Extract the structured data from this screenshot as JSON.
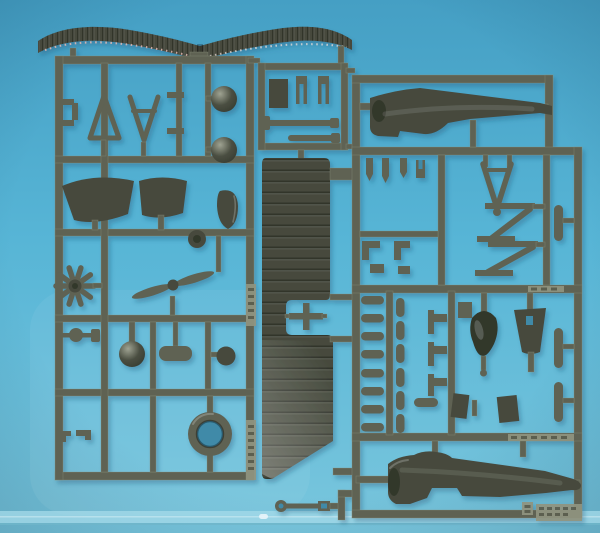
{
  "scene": {
    "type": "photograph",
    "subject": "Two dark olive-grey injection-molded model aircraft sprues on a light blue backdrop",
    "backdrop": "light blue paper with a fold line near the bottom edge",
    "plastic_description": "matte dark olive-grey styrene, light glinting on wing corrugations",
    "sprue_count": 3
  },
  "colors": {
    "backdrop_top": "#459fc4",
    "backdrop_mid": "#57b5d6",
    "backdrop_bottom": "#79c6dd",
    "table_strip": "#a6dbe9",
    "table_line": "#6fb5c9",
    "plastic": "#5e6253",
    "plastic_light": "#90947f",
    "plastic_dark": "#464a3d",
    "plastic_darker": "#33372c",
    "plastic_shine": "#b9bdae",
    "rib_glint": "#d2a8a2",
    "hole_shadow": "#3f8aa8",
    "shadow": "#16506e"
  },
  "sprues": {
    "left": {
      "name": "left parts frame",
      "parts": [
        "corrugated upper wing",
        "fuselage bracket",
        "windscreen frame",
        "cabane vee strut",
        "domed bowls",
        "seat fairings",
        "headrest fin",
        "wheel hub",
        "radial engine",
        "two-blade propeller",
        "axle shaft",
        "spinner dome",
        "seat pad",
        "wheel disc",
        "spring clips",
        "cowling ring",
        "embossed part-number plates"
      ]
    },
    "center": {
      "name": "lower wing and fittings",
      "parts": [
        "one-piece corrugated lower wing",
        "center-section cross brace",
        "control linkage rod",
        "small rod fittings",
        "fork fittings",
        "equipment box"
      ]
    },
    "right": {
      "name": "right parts frame",
      "parts": [
        "upper fuselage half",
        "lower fuselage half",
        "tail-skid vee strut",
        "diagonal interplane struts",
        "engine cylinders",
        "nose cowl bell",
        "tail fin",
        "tee fittings",
        "hook fittings",
        "axle capsules",
        "embossed maker plates"
      ]
    }
  },
  "embossed_text": {
    "legible": false,
    "description": "raised molded lettering on runner tags, too small to read"
  }
}
